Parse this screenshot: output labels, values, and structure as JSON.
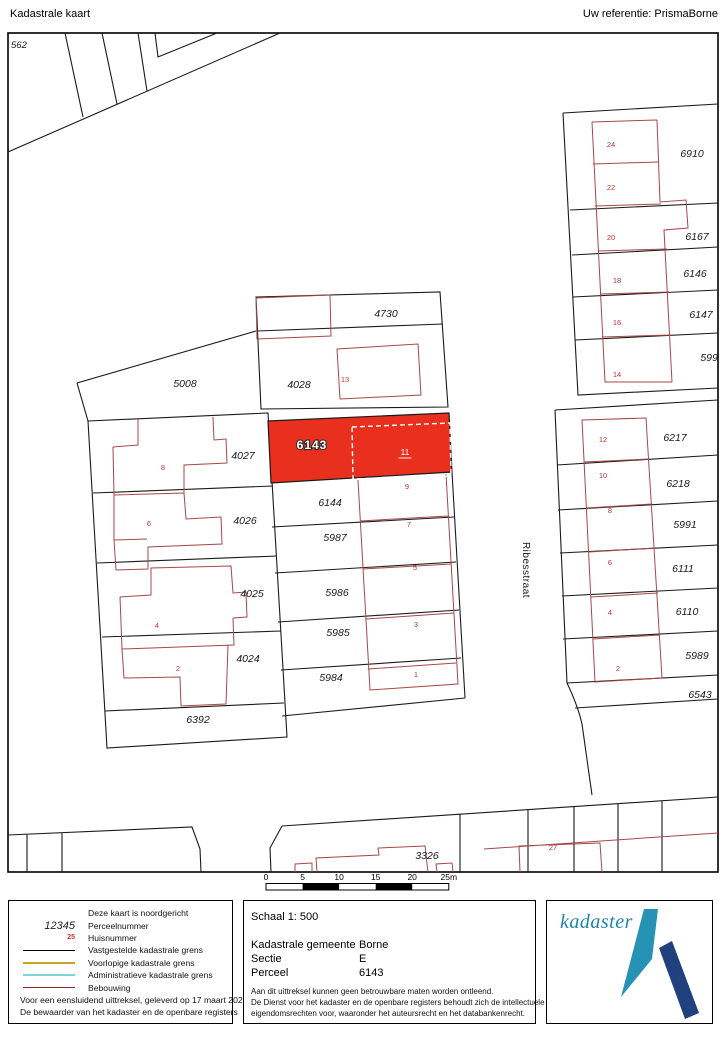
{
  "header": {
    "title": "Kadastrale kaart",
    "reference": "Uw referentie: PrismaBorne"
  },
  "map": {
    "corner_parcel": "562",
    "street": {
      "text": "Ribesstraat"
    },
    "highlight": {
      "parcel_number": "6143",
      "house_number": "11"
    },
    "parcel_labels": [
      {
        "text": "6910",
        "x": 692,
        "y": 157
      },
      {
        "text": "6167",
        "x": 697,
        "y": 240
      },
      {
        "text": "6146",
        "x": 695,
        "y": 277
      },
      {
        "text": "6147",
        "x": 701,
        "y": 318
      },
      {
        "text": "5997",
        "x": 712,
        "y": 361
      },
      {
        "text": "4730",
        "x": 386,
        "y": 317
      },
      {
        "text": "4028",
        "x": 299,
        "y": 388
      },
      {
        "text": "5008",
        "x": 185,
        "y": 387
      },
      {
        "text": "4027",
        "x": 243,
        "y": 459
      },
      {
        "text": "4026",
        "x": 245,
        "y": 524
      },
      {
        "text": "4025",
        "x": 252,
        "y": 597
      },
      {
        "text": "4024",
        "x": 248,
        "y": 662
      },
      {
        "text": "6392",
        "x": 198,
        "y": 723
      },
      {
        "text": "6144",
        "x": 330,
        "y": 506
      },
      {
        "text": "5987",
        "x": 335,
        "y": 541
      },
      {
        "text": "5986",
        "x": 337,
        "y": 596
      },
      {
        "text": "5985",
        "x": 338,
        "y": 636
      },
      {
        "text": "5984",
        "x": 331,
        "y": 681
      },
      {
        "text": "6217",
        "x": 675,
        "y": 441
      },
      {
        "text": "6218",
        "x": 678,
        "y": 487
      },
      {
        "text": "5991",
        "x": 685,
        "y": 528
      },
      {
        "text": "6111",
        "x": 683,
        "y": 572
      },
      {
        "text": "6110",
        "x": 687,
        "y": 615
      },
      {
        "text": "5989",
        "x": 697,
        "y": 659
      },
      {
        "text": "6543",
        "x": 700,
        "y": 698
      },
      {
        "text": "3326",
        "x": 427,
        "y": 859
      }
    ],
    "house_labels": [
      {
        "text": "24",
        "x": 611,
        "y": 147
      },
      {
        "text": "22",
        "x": 611,
        "y": 190
      },
      {
        "text": "20",
        "x": 611,
        "y": 240
      },
      {
        "text": "18",
        "x": 617,
        "y": 283
      },
      {
        "text": "16",
        "x": 617,
        "y": 325
      },
      {
        "text": "14",
        "x": 617,
        "y": 377
      },
      {
        "text": "13",
        "x": 345,
        "y": 382
      },
      {
        "text": "8",
        "x": 163,
        "y": 470
      },
      {
        "text": "6",
        "x": 149,
        "y": 526
      },
      {
        "text": "4",
        "x": 157,
        "y": 628
      },
      {
        "text": "2",
        "x": 178,
        "y": 671
      },
      {
        "text": "9",
        "x": 407,
        "y": 489
      },
      {
        "text": "7",
        "x": 409,
        "y": 527
      },
      {
        "text": "5",
        "x": 415,
        "y": 570
      },
      {
        "text": "3",
        "x": 416,
        "y": 627
      },
      {
        "text": "1",
        "x": 416,
        "y": 677
      },
      {
        "text": "12",
        "x": 603,
        "y": 442
      },
      {
        "text": "10",
        "x": 603,
        "y": 478
      },
      {
        "text": "8",
        "x": 610,
        "y": 513
      },
      {
        "text": "6",
        "x": 610,
        "y": 565
      },
      {
        "text": "4",
        "x": 610,
        "y": 615
      },
      {
        "text": "2",
        "x": 618,
        "y": 671
      },
      {
        "text": "27",
        "x": 553,
        "y": 850
      }
    ]
  },
  "scalebar": {
    "ticks": [
      "0",
      "5",
      "10",
      "15",
      "20",
      "25m"
    ]
  },
  "legend": {
    "items": [
      {
        "label": "Deze kaart is noordgericht",
        "type": "none"
      },
      {
        "label": "Perceelnummer",
        "type": "parcel-number",
        "sample": "12345"
      },
      {
        "label": "Huisnummer",
        "type": "house-number",
        "sample": "25"
      },
      {
        "label": "Vastgestelde kadastrale grens",
        "type": "line",
        "color": "#000000"
      },
      {
        "label": "Voorlopige kadastrale grens",
        "type": "line",
        "color": "#c9a227"
      },
      {
        "label": "Administratieve kadastrale grens",
        "type": "line",
        "color": "#7fd6d6"
      },
      {
        "label": "Bebouwing",
        "type": "line",
        "color": "#8f2a2a"
      }
    ],
    "footnote1": "Voor een eensluidend uittreksel, geleverd op 17 maart 2026",
    "footnote2": "De bewaarder van het kadaster en de openbare registers"
  },
  "details": {
    "scale_label": "Schaal 1: 500",
    "rows": [
      {
        "label": "Kadastrale gemeente",
        "value": "Borne"
      },
      {
        "label": "Sectie",
        "value": "E"
      },
      {
        "label": "Perceel",
        "value": "6143"
      }
    ],
    "disclaimer": [
      "Aan dit uittreksel kunnen geen betrouwbare maten worden ontleend.",
      "De Dienst voor het kadaster en de openbare registers behoudt zich de intellectuele",
      "eigendomsrechten voor, waaronder het auteursrecht en het databankenrecht."
    ]
  },
  "logo": {
    "text": "kadaster"
  },
  "colors": {
    "highlight_fill": "#e9301f",
    "building_line": "#a54848",
    "house_number": "#bf3434",
    "boundary": "#1a1a1a",
    "logo_teal": "#2693b4",
    "logo_dark": "#21417e",
    "logo_text": "#1f86a8"
  }
}
